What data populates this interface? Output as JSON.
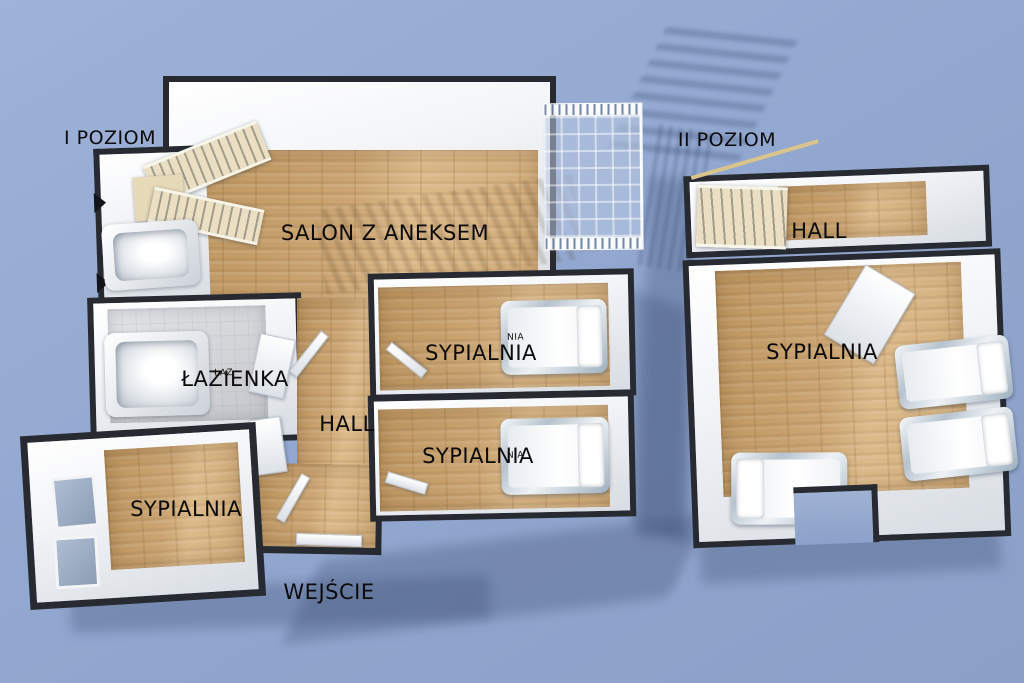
{
  "colors": {
    "background": "#93a8d0",
    "plan_outline": "#272b31",
    "wall_white": "#f2f4f7",
    "wood_floor": "#cda676",
    "bathroom_tile": "#d6d7da",
    "ground_shadow": "rgba(56,74,110,0.30)",
    "label_text": "#0b0b0c"
  },
  "level1": {
    "title": "I POZIOM",
    "rooms": {
      "salon": "SALON Z ANEKSEM",
      "bathroom": "ŁAZIENKA",
      "hall": "HALL",
      "bedroom_top": "SYPIALNIA",
      "bedroom_middle": "SYPIALNIA",
      "bedroom_bottom_left": "SYPIALNIA"
    },
    "entrance": "WEJŚCIE"
  },
  "level2": {
    "title": "II POZIOM",
    "rooms": {
      "hall": "HALL",
      "bedroom": "SYPIALNIA"
    }
  },
  "furniture_tags": {
    "bed_label_fragment": "NIA",
    "tub_label_fragment": "ŁAZ"
  }
}
